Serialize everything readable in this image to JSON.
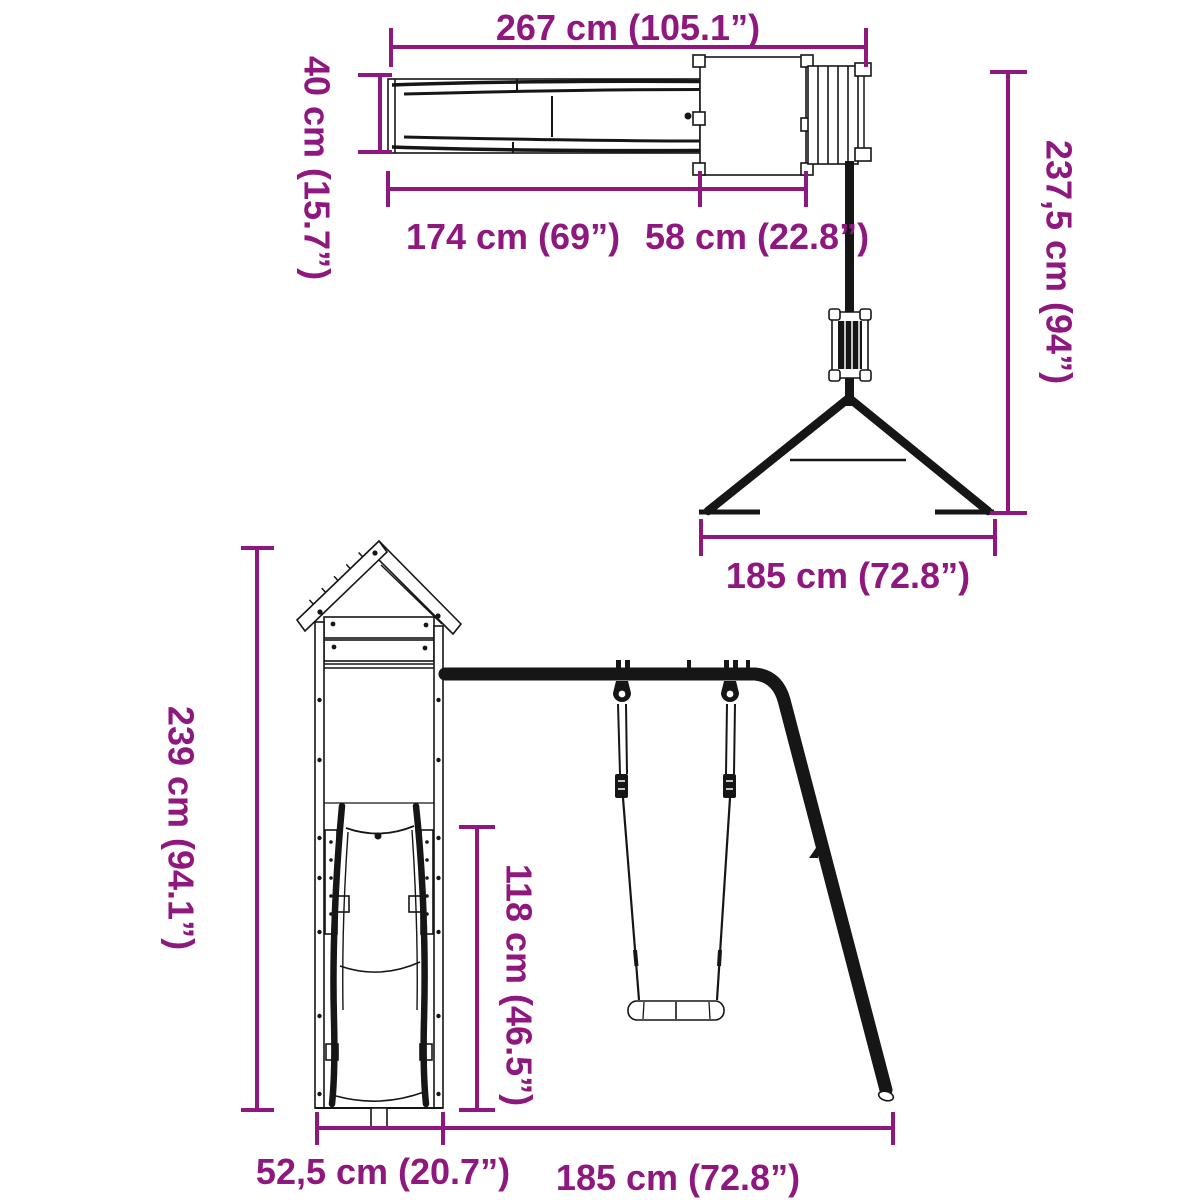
{
  "diagram": {
    "kind": "playset-dimension-diagram",
    "accent_color": "#8E187E",
    "line_color": "#161616",
    "background_color": "#ffffff",
    "top_view": {
      "name": "plan view (slide, tower platform, ladder, swing frame from above)",
      "dims": {
        "total_length": "267 cm (105.1”)",
        "slide_width": "40 cm (15.7”)",
        "slide_length": "174 cm (69”)",
        "platform_depth": "58 cm (22.8”)",
        "frame_depth": "237,5 cm (94”)",
        "frame_base_width": "185 cm (72.8”)"
      }
    },
    "front_view": {
      "name": "front view (tower with slide, swing beam, swing and diagonal leg)",
      "dims": {
        "total_height": "239 cm (94.1”)",
        "platform_height": "118 cm (46.5”)",
        "tower_width": "52,5 cm (20.7”)",
        "swing_section_width": "185 cm (72.8”)"
      }
    }
  }
}
